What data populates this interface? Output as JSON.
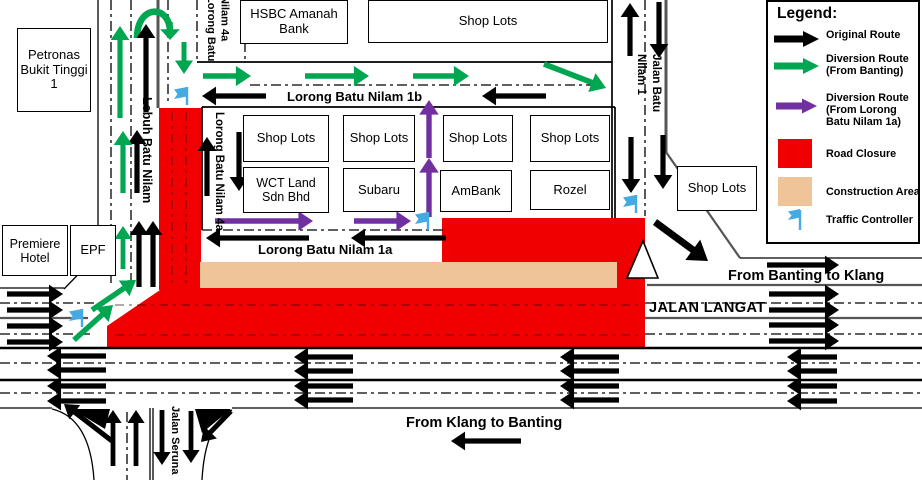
{
  "colors": {
    "original_route": "#000000",
    "diversion_banting": "#00a650",
    "diversion_lorong": "#7030a0",
    "road_closure": "#f00000",
    "construction": "#eec498",
    "traffic_controller": "#45aae1"
  },
  "legend": {
    "title": "Legend:",
    "items": [
      {
        "id": "original-route",
        "label": "Original Route"
      },
      {
        "id": "diversion-banting",
        "label": "Diversion Route (From Banting)"
      },
      {
        "id": "diversion-lorong",
        "label": "Diversion Route (From Lorong Batu Nilam 1a)"
      },
      {
        "id": "road-closure",
        "label": "Road Closure"
      },
      {
        "id": "construction-area",
        "label": "Construction Area"
      },
      {
        "id": "traffic-controller",
        "label": "Traffic Controller"
      }
    ]
  },
  "buildings": {
    "petronas": "Petronas Bukit Tinggi 1",
    "hsbc": "HSBC Amanah Bank",
    "shop_lots_top": "Shop Lots",
    "row1": [
      "Shop Lots",
      "Shop Lots",
      "Shop Lots",
      "Shop Lots"
    ],
    "row2": [
      "WCT Land Sdn Bhd",
      "Subaru",
      "AmBank",
      "Rozel"
    ],
    "premiere_hotel": "Premiere Hotel",
    "epf": "EPF",
    "shop_lots_right": "Shop Lots"
  },
  "streets": {
    "lebuh_batu_nilam": "Lebuh Batu Nilam",
    "lorong_batu_nilam_4a_top": "Lorong Batu Nilam 4a",
    "lorong_batu_nilam_4a": "Lorong Batu Nilam 4a",
    "lorong_batu_nilam_1b": "Lorong Batu Nilam 1b",
    "lorong_batu_nilam_1a": "Lorong Batu Nilam 1a",
    "jalan_batu_nilam_1": "Jalan Batu Nilam 1",
    "jalan_langat": "JALAN LANGAT",
    "jalan_seruna": "Jalan Seruna"
  },
  "directions": {
    "from_banting_to_klang": "From Banting to Klang",
    "from_klang_to_banting": "From Klang to Banting"
  }
}
